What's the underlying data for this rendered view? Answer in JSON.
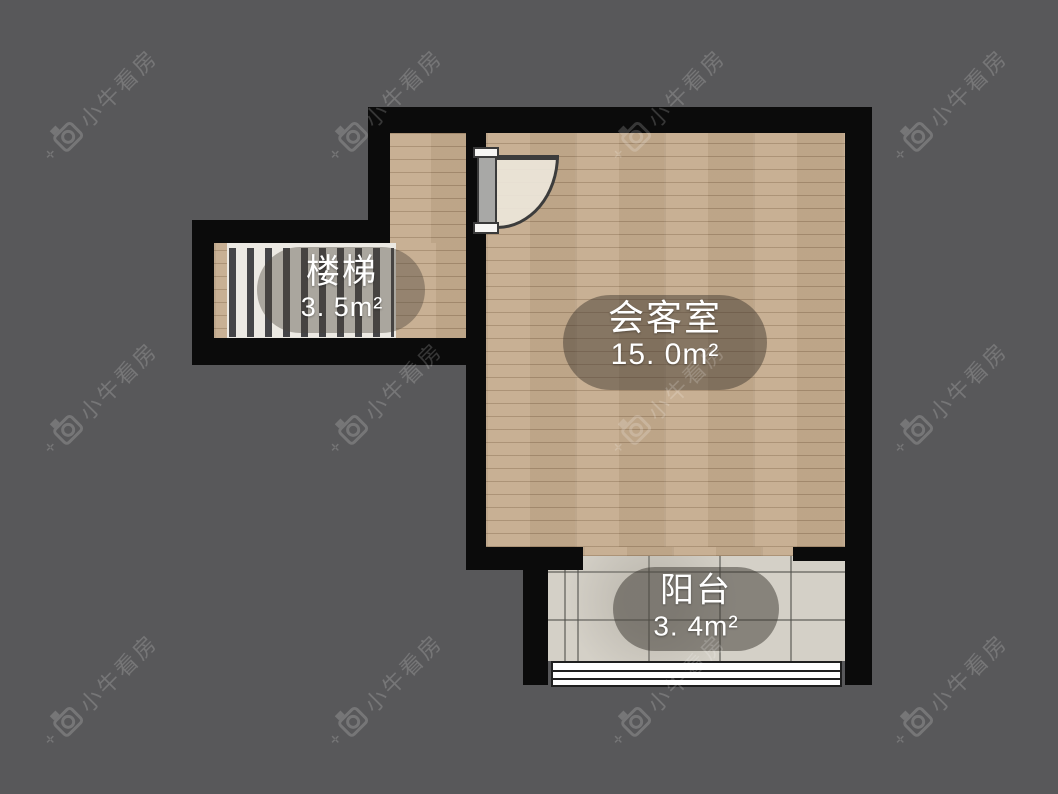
{
  "app": {
    "watermark_text": "小牛看房"
  },
  "floorplan": {
    "rooms": [
      {
        "id": "stairs",
        "name": "楼梯",
        "area": "3. 5m²"
      },
      {
        "id": "meeting",
        "name": "会客室",
        "area": "15. 0m²"
      },
      {
        "id": "balcony",
        "name": "阳台",
        "area": "3. 4m²"
      }
    ],
    "features": [
      "door-swing",
      "stair-treads",
      "balcony-window"
    ],
    "colors": {
      "background": "#58585a",
      "wall": "#0b0b0b",
      "wood_floor": "#c5ac8e",
      "tile_floor": "#d4d0c7",
      "stair_tread": "#ece9e3",
      "label_text": "#ffffff",
      "label_ellipse": "rgba(62,55,46,0.48)",
      "watermark": "rgba(255,255,255,0.18)"
    }
  }
}
